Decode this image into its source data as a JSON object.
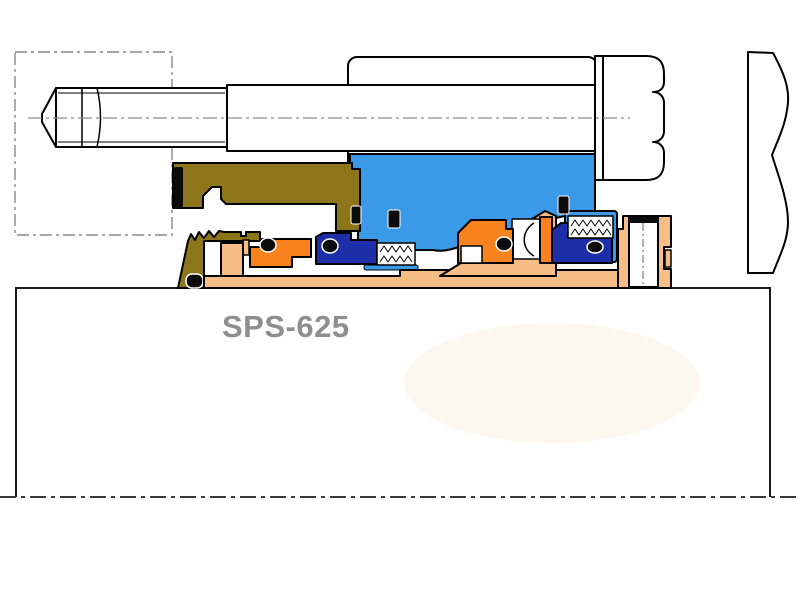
{
  "label": {
    "model": "SPS-625"
  },
  "palette": {
    "paper": "#FFFFFF",
    "outline": "#000000",
    "centerline_gray": "#8A8A8A",
    "shaft_centerline": "#3A3A3A",
    "gland_blue": "#3B9AE8",
    "gland_olive": "#8D7519",
    "face_orange": "#F8821E",
    "face_navy": "#1C2FA8",
    "sleeve_tan": "#F6BE86",
    "gasket_black": "#0B0B0B",
    "label_gray": "#8E8E8E",
    "watermark_cream": "#FAF3E6"
  }
}
